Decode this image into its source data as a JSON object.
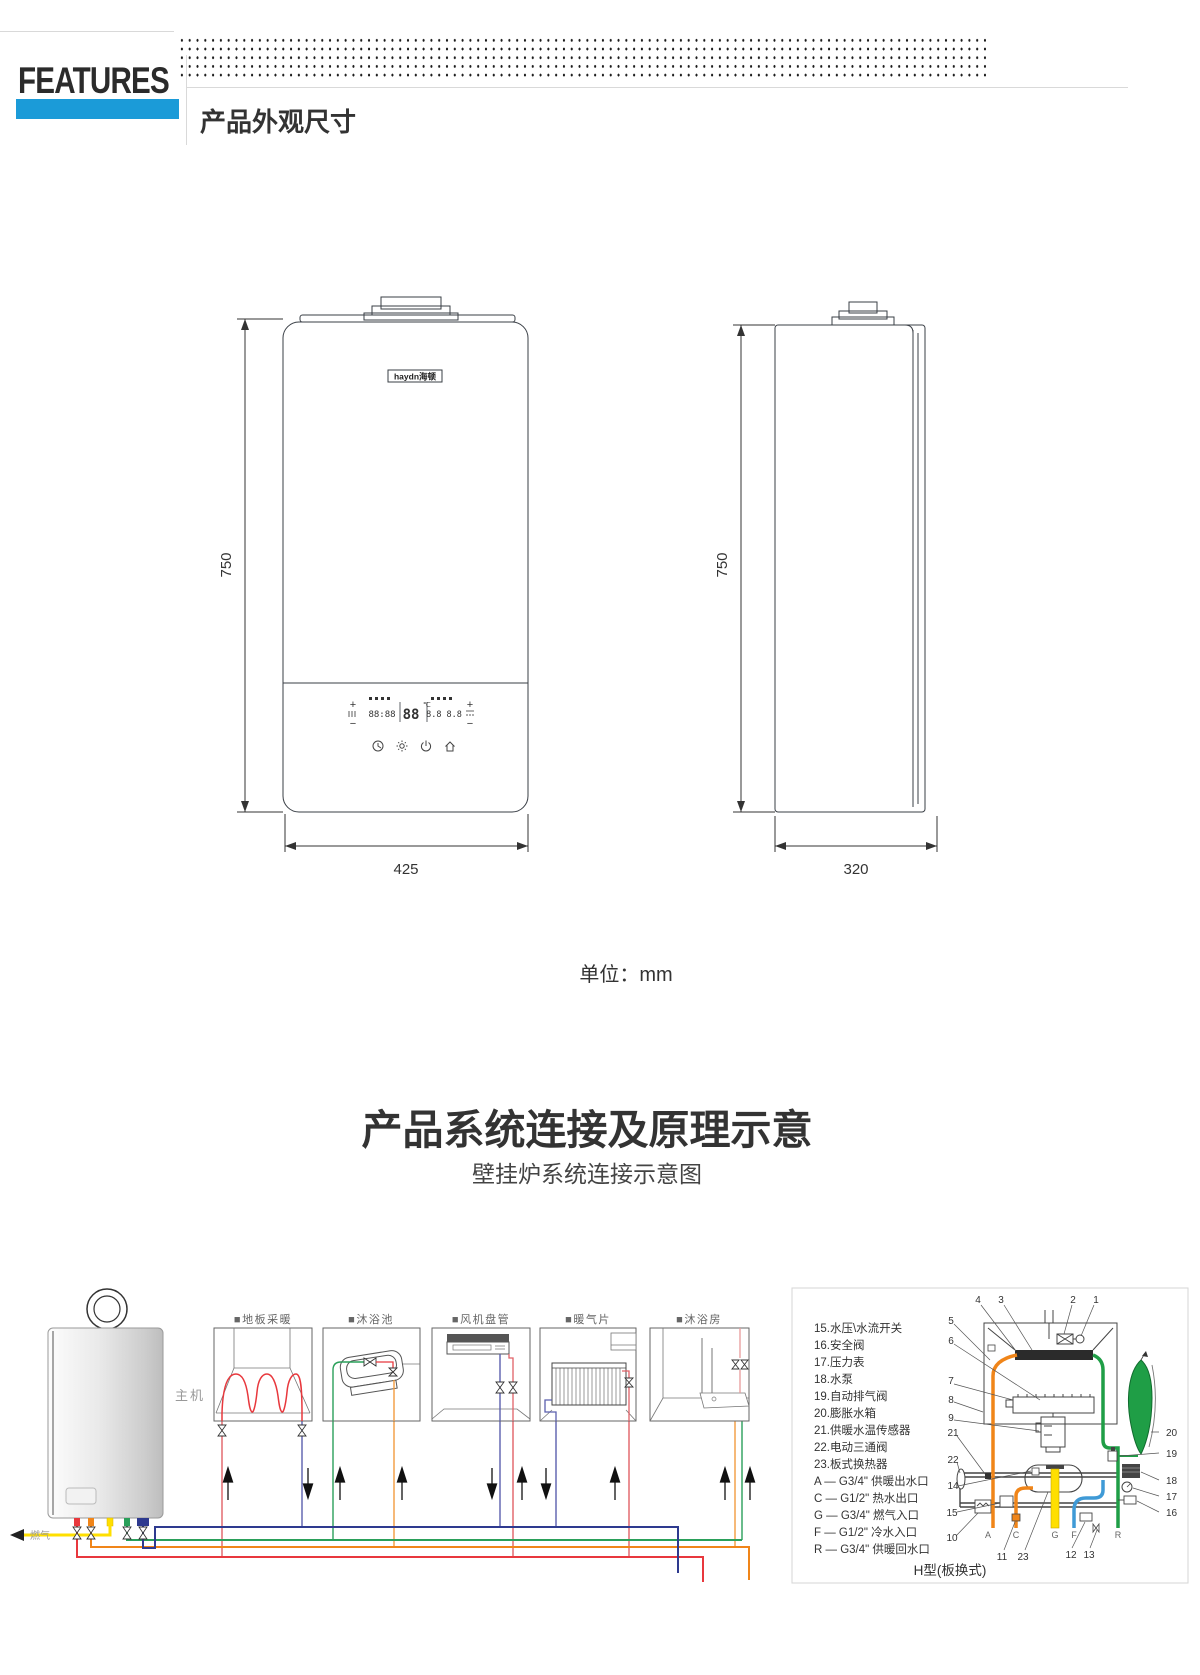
{
  "header": {
    "brand": "FEATURES",
    "accent_color": "#1b9bd8",
    "section_title": "产品外观尺寸"
  },
  "dims": {
    "front": {
      "logo": "haydn海顿",
      "height": "750",
      "width": "425",
      "display": {
        "plus": "+",
        "minus": "−",
        "digits_left": "88:88",
        "temp": "88",
        "temp_unit": "℃",
        "digits_right": "8.8 8.8"
      }
    },
    "side": {
      "height": "750",
      "width": "320"
    },
    "unit": "单位：mm"
  },
  "section2": {
    "title": "产品系统连接及原理示意",
    "subtitle": "壁挂炉系统连接示意图"
  },
  "diagram": {
    "boiler_label": "主机",
    "gas_label": "燃气",
    "panel_labels": [
      "■地板采暖",
      "■沐浴池",
      "■风机盘管",
      "■暖气片",
      "■沐浴房"
    ],
    "legend_items": [
      "15.水压\\水流开关",
      "16.安全阀",
      "17.压力表",
      "18.水泵",
      "19.自动排气阀",
      "20.膨胀水箱",
      "21.供暖水温传感器",
      "22.电动三通阀",
      "23.板式换热器"
    ],
    "legend_ports": [
      "A — G3/4\" 供暖出水口",
      "C — G1/2\" 热水出口",
      "G — G3/4\" 燃气入口",
      "F — G1/2\" 冷水入口",
      "R — G3/4\" 供暖回水口"
    ],
    "caption": "H型(板换式)",
    "callouts": {
      "top": [
        "4",
        "3",
        "2",
        "1"
      ],
      "left": [
        "5",
        "6",
        "7",
        "8",
        "9",
        "21",
        "22",
        "14",
        "15",
        "10"
      ],
      "bottom": [
        "11",
        "23",
        "12",
        "13"
      ],
      "right": [
        "20",
        "19",
        "18",
        "17",
        "16"
      ],
      "ports": [
        "A",
        "C",
        "G",
        "F",
        "R"
      ]
    },
    "pipe_colors": {
      "heating_supply": "#e8383d",
      "hot_water": "#f08519",
      "gas": "#ffdf00",
      "return_green": "#2aa05a",
      "cold_navy": "#2e3a8f",
      "cold_blue": "#3f9ad6"
    }
  }
}
